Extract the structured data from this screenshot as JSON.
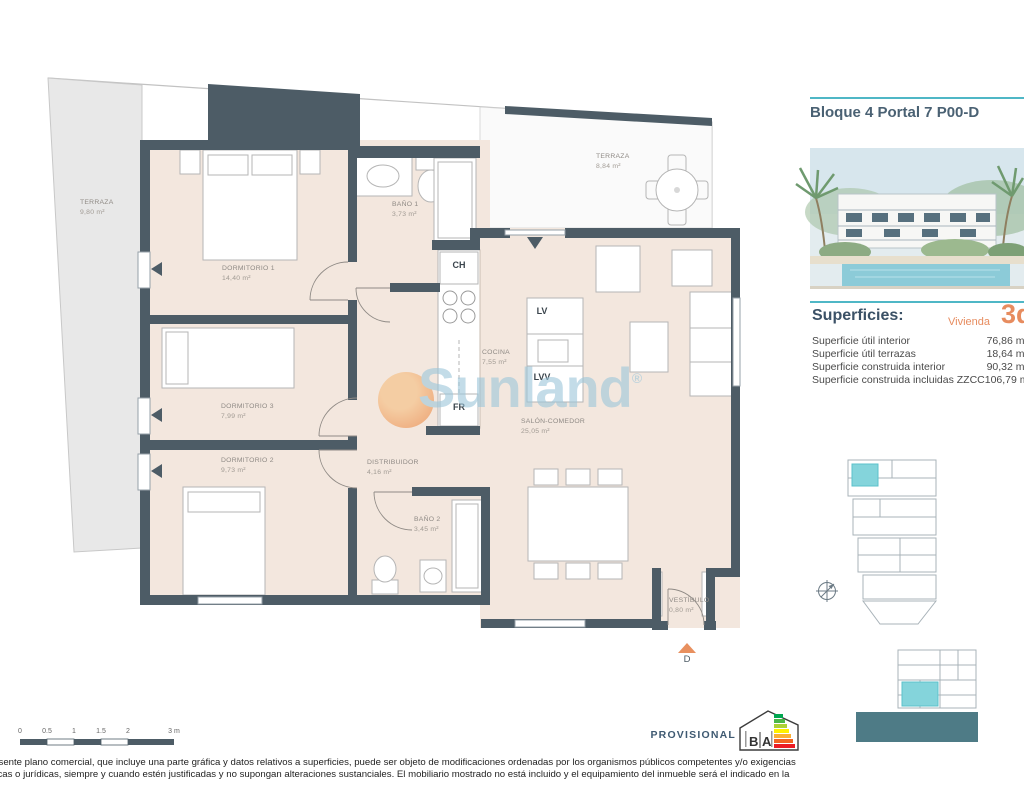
{
  "panel": {
    "title": "Bloque 4 Portal 7 P00-D",
    "superficies": {
      "heading": "Superficies:",
      "vivienda_label": "Vivienda",
      "vivienda_type": "3d",
      "rows": [
        {
          "label": "Superficie útil interior",
          "value": "76,86 m²"
        },
        {
          "label": "Superficie útil terrazas",
          "value": "18,64 m²"
        },
        {
          "label": "Superficie construida interior",
          "value": "90,32 m²"
        },
        {
          "label": "Superficie construida incluidas ZZCC",
          "value": "106,79 m²"
        }
      ]
    }
  },
  "plan": {
    "rooms": {
      "terraza_izq": {
        "name": "TERRAZA",
        "area": "9,80 m²"
      },
      "terraza_sup": {
        "name": "TERRAZA",
        "area": "8,84 m²"
      },
      "dormitorio1": {
        "name": "DORMITORIO 1",
        "area": "14,40 m²"
      },
      "dormitorio3": {
        "name": "DORMITORIO 3",
        "area": "7,99 m²"
      },
      "dormitorio2": {
        "name": "DORMITORIO 2",
        "area": "9,73 m²"
      },
      "bano1": {
        "name": "BAÑO 1",
        "area": "3,73 m²"
      },
      "bano2": {
        "name": "BAÑO 2",
        "area": "3,45 m²"
      },
      "cocina": {
        "name": "COCINA",
        "area": "7,55 m²"
      },
      "salon": {
        "name": "SALÓN-COMEDOR",
        "area": "25,05 m²"
      },
      "distribuidor": {
        "name": "DISTRIBUIDOR",
        "area": "4,16 m²"
      },
      "vestibulo": {
        "name": "VESTÍBULO",
        "area": "0,80 m²"
      }
    },
    "appliances": {
      "ch": "CH",
      "lv": "LV",
      "lvv": "LVV",
      "fr": "FR"
    },
    "entry_letter": "D"
  },
  "watermark": {
    "text": "Sunland",
    "registered": "®"
  },
  "scalebar": {
    "ticks": [
      "0",
      "0.5",
      "1",
      "1.5",
      "2",
      "3 m"
    ]
  },
  "footer": {
    "provisional": "PROVISIONAL",
    "energy_label": {
      "left": "B",
      "right": "A"
    },
    "disclaimer_line1": "resente plano comercial, que incluye una parte gráfica y datos relativos a superficies, puede ser objeto de modificaciones ordenadas por los organismos públicos competentes y/o exigencias",
    "disclaimer_line2": "nicas o jurídicas, siempre y cuando estén justificadas y no supongan alteraciones sustanciales. El mobiliario mostrado no está incluido y el equipamiento del inmueble será el indicado en la"
  },
  "colors": {
    "wall": "#4d5c66",
    "floor": "#f3e7de",
    "accent_teal": "#4fb7c6",
    "accent_orange": "#e8905f",
    "highlight_unit": "#84d4db",
    "watermark_blue": "#9cc6da"
  }
}
